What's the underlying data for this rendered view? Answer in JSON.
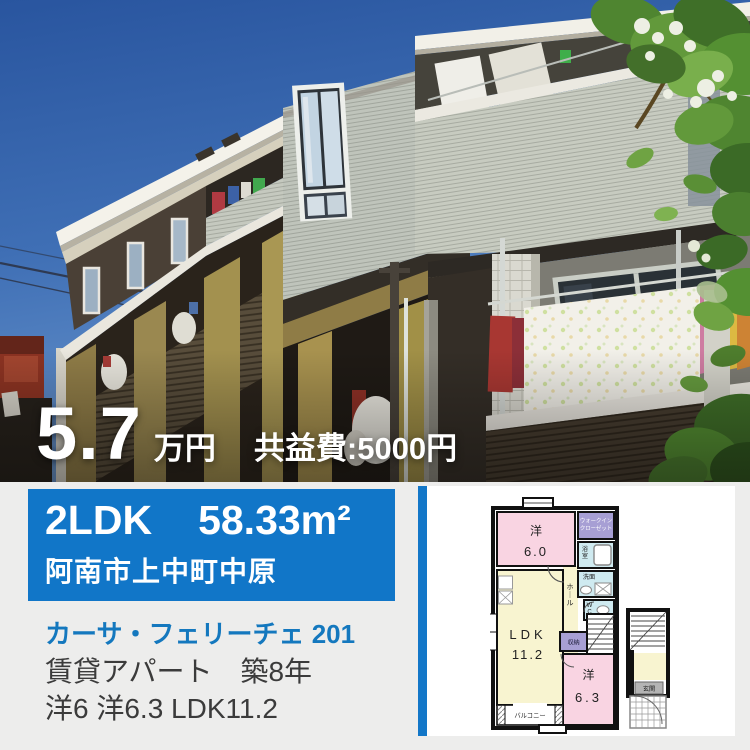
{
  "price": {
    "value": "5.7",
    "unit": "万円",
    "fee": "共益費:5000円"
  },
  "banner": {
    "layout": "2LDK",
    "area": "58.33m²",
    "address": "阿南市上中町中原"
  },
  "details": {
    "name": "カーサ・フェリーチェ 201",
    "type_age": "賃貸アパート　築8年",
    "rooms": "洋6 洋6.3 LDK11.2"
  },
  "floorplan": {
    "bedroom1": "洋",
    "bedroom1_size": "6.0",
    "wic1": "ウォークイン",
    "wic2": "クローゼット",
    "bath": "浴室",
    "wash": "洗面",
    "wc": "WC",
    "hall": "ホール",
    "ldk": "LDK",
    "ldk_size": "11.2",
    "storage": "収納",
    "bedroom2": "洋",
    "bedroom2_size": "6.3",
    "balcony": "バルコニー",
    "entrance": "玄関"
  },
  "colors": {
    "banner_blue": "#1176c8",
    "link_blue": "#1478be",
    "plan_pink": "#f9d4e2",
    "plan_yellow": "#f8f4d0",
    "plan_purple": "#a79fd4",
    "plan_aqua": "#cfeaf0"
  }
}
